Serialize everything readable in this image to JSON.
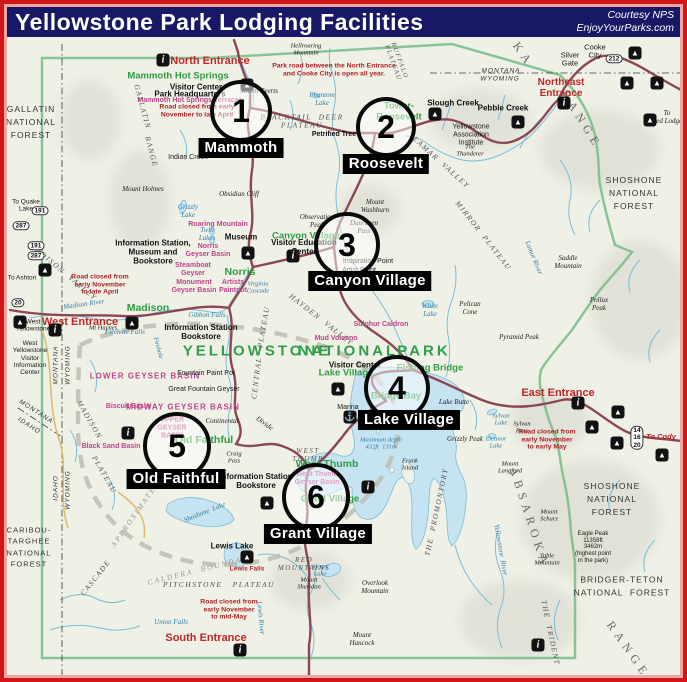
{
  "header": {
    "title": "Yellowstone Park Lodging Facilities",
    "credit1": "Courtesy NPS",
    "credit2": "EnjoyYourParks.com"
  },
  "colors": {
    "title_bg": "#181866",
    "border_outer": "#cf1717",
    "border_inner": "#f0a4a4",
    "road": "#8d4653",
    "road_secondary": "#dfb96d",
    "water_fill": "#c6e3f2",
    "water_line": "#79bed6",
    "boundary_green": "#7cc08d",
    "site_green": "#2e9e43",
    "thermal_magenta": "#c0448c",
    "note_red": "#b22222",
    "entrance_red": "#c22727"
  },
  "markers": [
    {
      "n": "1",
      "label": "Mammoth",
      "cx": 241,
      "cy": 111,
      "r": 27,
      "lx": 241,
      "ly": 148
    },
    {
      "n": "2",
      "label": "Roosevelt",
      "cx": 386,
      "cy": 127,
      "r": 26,
      "lx": 386,
      "ly": 164
    },
    {
      "n": "3",
      "label": "Canyon Village",
      "cx": 347,
      "cy": 245,
      "r": 29,
      "lx": 370,
      "ly": 281
    },
    {
      "n": "4",
      "label": "Lake Village",
      "cx": 397,
      "cy": 388,
      "r": 29,
      "lx": 409,
      "ly": 420
    },
    {
      "n": "5",
      "label": "Old Faithful",
      "cx": 177,
      "cy": 446,
      "r": 30,
      "lx": 176,
      "ly": 479
    },
    {
      "n": "6",
      "label": "Grant Village",
      "cx": 316,
      "cy": 497,
      "r": 30,
      "lx": 318,
      "ly": 534
    }
  ],
  "icon_glyphs": {
    "tent": "▲",
    "info": "i",
    "marina": "⚓"
  },
  "labels": [
    {
      "t": "North Entrance",
      "x": 210,
      "y": 61,
      "c": "ent"
    },
    {
      "t": "Northeast\nEntrance",
      "x": 561,
      "y": 88,
      "c": "ent",
      "s": 10
    },
    {
      "t": "West Entrance",
      "x": 80,
      "y": 322,
      "c": "ent"
    },
    {
      "t": "East Entrance",
      "x": 558,
      "y": 393,
      "c": "ent"
    },
    {
      "t": "South Entrance",
      "x": 206,
      "y": 638,
      "c": "ent"
    },
    {
      "t": "Mammoth Hot Springs",
      "x": 178,
      "y": 77,
      "c": "grn"
    },
    {
      "t": "Tower-\nRoosevelt",
      "x": 399,
      "y": 112,
      "c": "grn"
    },
    {
      "t": "Canyon Village",
      "x": 306,
      "y": 237,
      "c": "grn"
    },
    {
      "t": "Norris",
      "x": 240,
      "y": 273,
      "c": "grn",
      "s": 10.5
    },
    {
      "t": "Madison",
      "x": 148,
      "y": 309,
      "c": "grn",
      "s": 10.5
    },
    {
      "t": "Old Faithful",
      "x": 204,
      "y": 441,
      "c": "grn",
      "s": 10.5
    },
    {
      "t": "Lake Village",
      "x": 346,
      "y": 374,
      "c": "grn"
    },
    {
      "t": "Fishing Bridge",
      "x": 430,
      "y": 369,
      "c": "grn"
    },
    {
      "t": "Bridge Bay",
      "x": 396,
      "y": 397,
      "c": "grn"
    },
    {
      "t": "West Thumb",
      "x": 327,
      "y": 465,
      "c": "grn",
      "s": 10.5
    },
    {
      "t": "Grant Village",
      "x": 330,
      "y": 500,
      "c": "grn"
    },
    {
      "t": "YELLOWSTONE",
      "x": 257,
      "y": 352,
      "c": "grnlg"
    },
    {
      "t": "NATIONAL",
      "x": 348,
      "y": 352,
      "c": "grnlg"
    },
    {
      "t": "PARK",
      "x": 424,
      "y": 352,
      "c": "grnlg"
    },
    {
      "t": "Mammoth Hot Springs Terraces",
      "x": 190,
      "y": 101,
      "c": "mag"
    },
    {
      "t": "Roaring Mountain",
      "x": 218,
      "y": 225,
      "c": "mag"
    },
    {
      "t": "Norris\nGeyser Basin",
      "x": 208,
      "y": 251,
      "c": "mag"
    },
    {
      "t": "Steamboat\nGeyser",
      "x": 193,
      "y": 270,
      "c": "mag"
    },
    {
      "t": "Monument\nGeyser Basin",
      "x": 194,
      "y": 287,
      "c": "mag"
    },
    {
      "t": "Artists\nPaintpot",
      "x": 233,
      "y": 287,
      "c": "mag"
    },
    {
      "t": "LOWER GEYSER BASIN",
      "x": 145,
      "y": 377,
      "c": "magcaps"
    },
    {
      "t": "MIDWAY GEYSER BASIN",
      "x": 183,
      "y": 408,
      "c": "magcaps"
    },
    {
      "t": "Biscuit Basin",
      "x": 128,
      "y": 407,
      "c": "mag"
    },
    {
      "t": "UPPER\nGEYSER\nBASIN",
      "x": 172,
      "y": 428,
      "c": "mag"
    },
    {
      "t": "Black Sand Basin",
      "x": 111,
      "y": 447,
      "c": "mag"
    },
    {
      "t": "West Thumb\nGeyser Basin",
      "x": 317,
      "y": 479,
      "c": "mag"
    },
    {
      "t": "Mud Volcano",
      "x": 336,
      "y": 339,
      "c": "mag"
    },
    {
      "t": "Sulphur Caldron",
      "x": 381,
      "y": 325,
      "c": "mag"
    },
    {
      "t": "Fountain Paint Pot",
      "x": 206,
      "y": 374,
      "c": "blk"
    },
    {
      "t": "Great Fountain Geyser",
      "x": 204,
      "y": 390,
      "c": "blk"
    },
    {
      "t": "Visitor Center",
      "x": 196,
      "y": 88,
      "c": "blkb"
    },
    {
      "t": "Park Headquarters",
      "x": 190,
      "y": 95,
      "c": "blkb"
    },
    {
      "t": "Road closed from early\nNovember to late April",
      "x": 197,
      "y": 111,
      "c": "note"
    },
    {
      "t": "Park road between the North Entrance\nand Cooke City is open all year.",
      "x": 334,
      "y": 70,
      "c": "note"
    },
    {
      "t": "Mount Everts",
      "x": 259,
      "y": 92,
      "c": "ita"
    },
    {
      "t": "BLACKTAIL  DEER\nPLATEAU",
      "x": 302,
      "y": 122,
      "c": "caps"
    },
    {
      "t": "Petrified Tree",
      "x": 334,
      "y": 135,
      "c": "blkb",
      "s": 7
    },
    {
      "t": "Phantom\nLake",
      "x": 322,
      "y": 100,
      "c": "wtr"
    },
    {
      "t": "Indian Creek",
      "x": 188,
      "y": 158,
      "c": "blk"
    },
    {
      "t": "Hellroaring\nMountain",
      "x": 306,
      "y": 50,
      "c": "ita",
      "s": 6.5
    },
    {
      "t": "Slough Creek",
      "x": 453,
      "y": 104,
      "c": "blkb"
    },
    {
      "t": "Pebble Creek",
      "x": 503,
      "y": 109,
      "c": "blkb"
    },
    {
      "t": "Yellowstone\nAssociation\nInstitute",
      "x": 471,
      "y": 135,
      "c": "blk"
    },
    {
      "t": "LAMAR  VALLEY",
      "x": 441,
      "y": 163,
      "c": "caps",
      "r": 42
    },
    {
      "t": "The\nThunderer",
      "x": 470,
      "y": 151,
      "c": "ita",
      "s": 6.5
    },
    {
      "t": "Cooke\nCity",
      "x": 595,
      "y": 52,
      "c": "blk",
      "s": 7.5
    },
    {
      "t": "Silver\nGate",
      "x": 570,
      "y": 60,
      "c": "blk",
      "s": 7.5
    },
    {
      "t": "MONTANA",
      "x": 501,
      "y": 71,
      "c": "state"
    },
    {
      "t": "WYOMING",
      "x": 500,
      "y": 79,
      "c": "state"
    },
    {
      "t": "To\nRed Lodge",
      "x": 667,
      "y": 118,
      "c": "ita",
      "s": 7
    },
    {
      "t": "Mount Holmes",
      "x": 143,
      "y": 190,
      "c": "ita"
    },
    {
      "t": "Obsidian Cliff",
      "x": 239,
      "y": 195,
      "c": "ita"
    },
    {
      "t": "Grizzly\nLake",
      "x": 188,
      "y": 212,
      "c": "wtr"
    },
    {
      "t": "Twin\nLakes",
      "x": 207,
      "y": 235,
      "c": "wtr"
    },
    {
      "t": "Museum",
      "x": 241,
      "y": 238,
      "c": "blkb"
    },
    {
      "t": "Information Station,\nMuseum and\nBookstore",
      "x": 153,
      "y": 253,
      "c": "blkb"
    },
    {
      "t": "Road closed from\nearly November\nto late April",
      "x": 100,
      "y": 285,
      "c": "note"
    },
    {
      "t": "Mount\nWashburn",
      "x": 375,
      "y": 207,
      "c": "ita"
    },
    {
      "t": "Dunraven\nPass",
      "x": 364,
      "y": 228,
      "c": "ita"
    },
    {
      "t": "Observation\nPeak",
      "x": 317,
      "y": 222,
      "c": "ita"
    },
    {
      "t": "Visitor Education\nCenter",
      "x": 304,
      "y": 248,
      "c": "blkb"
    },
    {
      "t": "Inspiration Point",
      "x": 368,
      "y": 262,
      "c": "blk"
    },
    {
      "t": "Artist Point",
      "x": 359,
      "y": 271,
      "c": "blk"
    },
    {
      "t": "Virginia\nCascade",
      "x": 258,
      "y": 288,
      "c": "wtr",
      "s": 6.5
    },
    {
      "t": "Gibbon Falls",
      "x": 207,
      "y": 316,
      "c": "wtr"
    },
    {
      "t": "Firehole Falls",
      "x": 125,
      "y": 333,
      "c": "wtr"
    },
    {
      "t": "Firehole",
      "x": 158,
      "y": 348,
      "c": "wtr",
      "r": 75,
      "s": 6.5
    },
    {
      "t": "Mt Haynes",
      "x": 103,
      "y": 328,
      "c": "ita",
      "s": 6.5
    },
    {
      "t": "Madison River",
      "x": 84,
      "y": 305,
      "c": "wtr",
      "r": -8
    },
    {
      "t": "MIRROR  PLATEAU",
      "x": 483,
      "y": 236,
      "c": "caps",
      "r": 52
    },
    {
      "t": "Saddle\nMountain",
      "x": 568,
      "y": 263,
      "c": "ita"
    },
    {
      "t": "Pelican\nCone",
      "x": 470,
      "y": 309,
      "c": "ita"
    },
    {
      "t": "White\nLake",
      "x": 430,
      "y": 311,
      "c": "wtr"
    },
    {
      "t": "Pyramid Peak",
      "x": 519,
      "y": 338,
      "c": "ita"
    },
    {
      "t": "Pollux\nPeak",
      "x": 599,
      "y": 305,
      "c": "ita"
    },
    {
      "t": "Lamar River",
      "x": 533,
      "y": 258,
      "c": "wtr",
      "r": 68
    },
    {
      "t": "HAYDEN  VALLEY",
      "x": 321,
      "y": 320,
      "c": "caps",
      "r": 38
    },
    {
      "t": "CENTRAL",
      "x": 257,
      "y": 378,
      "c": "caps",
      "r": -83
    },
    {
      "t": "PLATEAU",
      "x": 264,
      "y": 327,
      "c": "caps",
      "r": -80
    },
    {
      "t": "Visitor Center",
      "x": 355,
      "y": 366,
      "c": "blkb"
    },
    {
      "t": "Marina",
      "x": 348,
      "y": 408,
      "c": "blk"
    },
    {
      "t": "Lake Butte",
      "x": 454,
      "y": 403,
      "c": "ita"
    },
    {
      "t": "Grizzly Peak",
      "x": 465,
      "y": 440,
      "c": "ita"
    },
    {
      "t": "Sylvan\nLake",
      "x": 501,
      "y": 420,
      "c": "wtr",
      "s": 6.5
    },
    {
      "t": "Sylvan\nPass",
      "x": 522,
      "y": 428,
      "c": "ita",
      "s": 6.5
    },
    {
      "t": "Eleanor\nLake",
      "x": 496,
      "y": 443,
      "c": "wtr",
      "s": 6.5
    },
    {
      "t": "Mount\nLangford",
      "x": 510,
      "y": 468,
      "c": "ita",
      "s": 6.5
    },
    {
      "t": "Road closed from\nearly November\nto early May",
      "x": 547,
      "y": 440,
      "c": "note"
    },
    {
      "t": "To Cody",
      "x": 661,
      "y": 437,
      "c": "tored"
    },
    {
      "t": "Maximum depth\n432ft  131m",
      "x": 381,
      "y": 444,
      "c": "wtr",
      "s": 6.5
    },
    {
      "t": "WEST\nTHUMB",
      "x": 308,
      "y": 456,
      "c": "caps",
      "s": 7
    },
    {
      "t": "Frank\nIsland",
      "x": 410,
      "y": 465,
      "c": "ita",
      "s": 6.5
    },
    {
      "t": "THE  PROMONTORY",
      "x": 437,
      "y": 512,
      "c": "caps",
      "r": -78
    },
    {
      "t": "Heart\nLake",
      "x": 320,
      "y": 571,
      "c": "wtr",
      "s": 6.5
    },
    {
      "t": "Mount\nSheridan",
      "x": 309,
      "y": 584,
      "c": "ita",
      "s": 6.5
    },
    {
      "t": "RED\nMOUNTAINS",
      "x": 304,
      "y": 565,
      "c": "caps",
      "s": 7
    },
    {
      "t": "Overlook\nMountain",
      "x": 375,
      "y": 588,
      "c": "ita"
    },
    {
      "t": "Mount\nHancock",
      "x": 362,
      "y": 640,
      "c": "ita"
    },
    {
      "t": "Lewis Lake",
      "x": 232,
      "y": 547,
      "c": "blkb"
    },
    {
      "t": "Lewis Falls",
      "x": 247,
      "y": 569,
      "c": "note",
      "s": 6.5
    },
    {
      "t": "Shoshone  Lake",
      "x": 205,
      "y": 513,
      "c": "wtr",
      "r": -22
    },
    {
      "t": "Lewis River",
      "x": 260,
      "y": 618,
      "c": "wtr",
      "r": 85
    },
    {
      "t": "Union Falls",
      "x": 171,
      "y": 623,
      "c": "wtr"
    },
    {
      "t": "PITCHSTONE   PLATEAU",
      "x": 219,
      "y": 585,
      "c": "caps"
    },
    {
      "t": "APPROXIMATE",
      "x": 134,
      "y": 517,
      "c": "cald",
      "r": -55
    },
    {
      "t": "CALDERA  BOUNDARY",
      "x": 201,
      "y": 570,
      "c": "cald",
      "r": -14
    },
    {
      "t": "CASCADE",
      "x": 96,
      "y": 578,
      "c": "caps",
      "r": -52
    },
    {
      "t": "Road closed from\nearly November\nto mid-May",
      "x": 229,
      "y": 610,
      "c": "note"
    },
    {
      "t": "GALLATIN\nNATIONAL\nFOREST",
      "x": 31,
      "y": 122,
      "c": "forest"
    },
    {
      "t": "SHOSHONE\nNATIONAL\nFOREST",
      "x": 634,
      "y": 193,
      "c": "forest"
    },
    {
      "t": "SHOSHONE\nNATIONAL\nFOREST",
      "x": 612,
      "y": 499,
      "c": "forest"
    },
    {
      "t": "BRIDGER-TETON\nNATIONAL  FOREST",
      "x": 622,
      "y": 586,
      "c": "forest"
    },
    {
      "t": "CARIBOU-\nTARGHEE\nNATIONAL\nFOREST",
      "x": 29,
      "y": 547,
      "c": "forest",
      "s": 7.5
    },
    {
      "t": "ABSAROKA",
      "x": 529,
      "y": 518,
      "c": "range",
      "r": 72
    },
    {
      "t": "RANGE",
      "x": 628,
      "y": 650,
      "c": "range",
      "r": 55
    },
    {
      "t": "RANGE",
      "x": 581,
      "y": 120,
      "c": "range",
      "r": 58
    },
    {
      "t": "KA",
      "x": 523,
      "y": 55,
      "c": "range",
      "r": 55
    },
    {
      "t": "THE  TRIDENT",
      "x": 550,
      "y": 633,
      "c": "caps",
      "r": 78
    },
    {
      "t": "Mount\nSchurz",
      "x": 549,
      "y": 516,
      "c": "ita",
      "s": 6.5
    },
    {
      "t": "Eagle Peak\n11358ft\n3462m\n(highest point\nin the park)",
      "x": 593,
      "y": 548,
      "c": "blk",
      "s": 6
    },
    {
      "t": "Table\nMountain",
      "x": 547,
      "y": 560,
      "c": "ita",
      "s": 6.5
    },
    {
      "t": "Yellowstone  River",
      "x": 500,
      "y": 550,
      "c": "wtr",
      "r": 80
    },
    {
      "t": "GALLATIN",
      "x": 142,
      "y": 107,
      "c": "caps",
      "r": 75
    },
    {
      "t": "RANGE",
      "x": 151,
      "y": 152,
      "c": "caps",
      "r": 75
    },
    {
      "t": "MADISON  VALLEY",
      "x": 63,
      "y": 272,
      "c": "caps",
      "r": 40
    },
    {
      "t": "MONTANA",
      "x": 56,
      "y": 365,
      "c": "state",
      "r": -90
    },
    {
      "t": "WYOMING",
      "x": 68,
      "y": 365,
      "c": "state",
      "r": -90
    },
    {
      "t": "MONTANA",
      "x": 36,
      "y": 412,
      "c": "state",
      "r": 33
    },
    {
      "t": "IDAHO",
      "x": 29,
      "y": 426,
      "c": "state",
      "r": 33
    },
    {
      "t": "IDAHO",
      "x": 56,
      "y": 488,
      "c": "state",
      "r": -90
    },
    {
      "t": "WYOMING",
      "x": 68,
      "y": 490,
      "c": "state",
      "r": -90
    },
    {
      "t": "MADISON",
      "x": 89,
      "y": 420,
      "c": "caps",
      "r": 60
    },
    {
      "t": "PLATEAU",
      "x": 104,
      "y": 475,
      "c": "caps",
      "r": 60
    },
    {
      "t": "West\nYellowstone",
      "x": 33,
      "y": 326,
      "c": "blk",
      "s": 6.5
    },
    {
      "t": "West\nYellowstone\nVisitor\nInformation\nCenter",
      "x": 30,
      "y": 358,
      "c": "blk",
      "s": 6.5
    },
    {
      "t": "Information Station\nBookstore",
      "x": 201,
      "y": 333,
      "c": "blkb"
    },
    {
      "t": "Information Station\nBookstore",
      "x": 256,
      "y": 482,
      "c": "blkb"
    },
    {
      "t": "Continental",
      "x": 222,
      "y": 422,
      "c": "ita",
      "s": 7
    },
    {
      "t": "Divide",
      "x": 264,
      "y": 424,
      "c": "ita",
      "s": 7,
      "r": 35
    },
    {
      "t": "Craig\nPass",
      "x": 234,
      "y": 458,
      "c": "ita",
      "s": 6.5
    },
    {
      "t": "To Quake\nLake",
      "x": 26,
      "y": 206,
      "c": "blk",
      "s": 6.5
    },
    {
      "t": "To Ashton",
      "x": 22,
      "y": 278,
      "c": "blk",
      "s": 6.5
    },
    {
      "t": "BUFFALO\nPLATEAU",
      "x": 396,
      "y": 62,
      "c": "caps",
      "r": 70,
      "s": 6.5
    }
  ],
  "icons": [
    {
      "x": 163,
      "y": 60,
      "k": "info"
    },
    {
      "x": 247,
      "y": 85,
      "k": "tent"
    },
    {
      "x": 248,
      "y": 253,
      "k": "tent"
    },
    {
      "x": 132,
      "y": 323,
      "k": "tent"
    },
    {
      "x": 55,
      "y": 330,
      "k": "info"
    },
    {
      "x": 20,
      "y": 322,
      "k": "tent"
    },
    {
      "x": 128,
      "y": 433,
      "k": "info"
    },
    {
      "x": 338,
      "y": 389,
      "k": "tent"
    },
    {
      "x": 350,
      "y": 417,
      "k": "marina"
    },
    {
      "x": 293,
      "y": 256,
      "k": "info"
    },
    {
      "x": 368,
      "y": 487,
      "k": "info"
    },
    {
      "x": 267,
      "y": 503,
      "k": "tent"
    },
    {
      "x": 247,
      "y": 557,
      "k": "tent"
    },
    {
      "x": 240,
      "y": 650,
      "k": "info"
    },
    {
      "x": 564,
      "y": 103,
      "k": "info"
    },
    {
      "x": 635,
      "y": 53,
      "k": "tent"
    },
    {
      "x": 627,
      "y": 83,
      "k": "tent"
    },
    {
      "x": 657,
      "y": 83,
      "k": "tent"
    },
    {
      "x": 650,
      "y": 120,
      "k": "tent"
    },
    {
      "x": 435,
      "y": 114,
      "k": "tent"
    },
    {
      "x": 518,
      "y": 122,
      "k": "tent"
    },
    {
      "x": 578,
      "y": 403,
      "k": "info"
    },
    {
      "x": 618,
      "y": 412,
      "k": "tent"
    },
    {
      "x": 592,
      "y": 427,
      "k": "tent"
    },
    {
      "x": 617,
      "y": 443,
      "k": "tent"
    },
    {
      "x": 662,
      "y": 455,
      "k": "tent"
    },
    {
      "x": 45,
      "y": 270,
      "k": "tent"
    },
    {
      "x": 538,
      "y": 645,
      "k": "info"
    }
  ],
  "shields": [
    {
      "t": "191",
      "x": 40,
      "y": 211
    },
    {
      "t": "287",
      "x": 21,
      "y": 226
    },
    {
      "t": "191",
      "x": 36,
      "y": 246
    },
    {
      "t": "287",
      "x": 36,
      "y": 256
    },
    {
      "t": "20",
      "x": 18,
      "y": 303
    },
    {
      "t": "212",
      "x": 614,
      "y": 59
    },
    {
      "t": "14\n16\n20",
      "x": 637,
      "y": 438
    }
  ]
}
